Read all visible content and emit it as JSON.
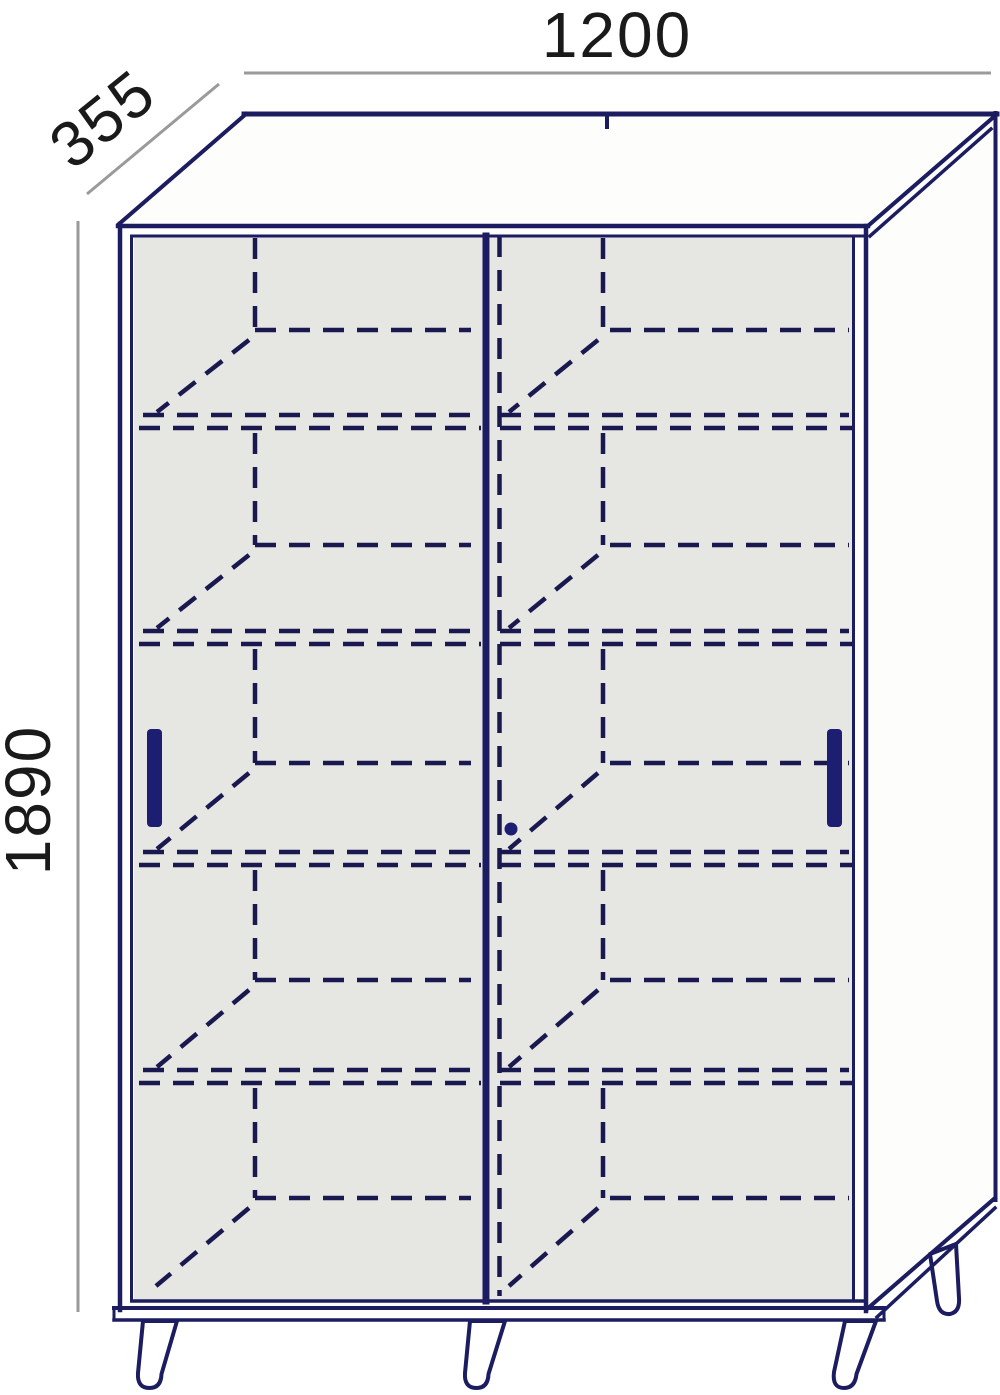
{
  "drawing": {
    "type": "furniture-dimension-diagram",
    "item": "two-door sliding wardrobe with hidden interior shelves, four legs",
    "dimensions": {
      "width_mm": "1200",
      "depth_mm": "355",
      "height_mm": "1890"
    },
    "colors": {
      "outline": "#1c1c60",
      "hidden_line": "#191950",
      "dimension_line": "#9a9a9a",
      "label_text": "#1a1a1a",
      "door_fill": "#e6e6e3",
      "panel_fill": "#fdfdfc",
      "handle_fill": "#1d1d72",
      "background": "#ffffff"
    },
    "features": {
      "door_count": 2,
      "handle_count": 2,
      "leg_count": 4,
      "shelf_sections": 5,
      "lock_pin": 1
    },
    "shelf_sections": [
      {
        "top": 238,
        "rear": 330,
        "front": 421,
        "bottom": false
      },
      {
        "top": 433,
        "rear": 545,
        "front": 637,
        "bottom": false
      },
      {
        "top": 649,
        "rear": 763,
        "front": 858,
        "bottom": false
      },
      {
        "top": 870,
        "rear": 980,
        "front": 1076,
        "bottom": false
      },
      {
        "top": 1088,
        "rear": 1198,
        "front": 1293,
        "bottom": true
      }
    ]
  }
}
